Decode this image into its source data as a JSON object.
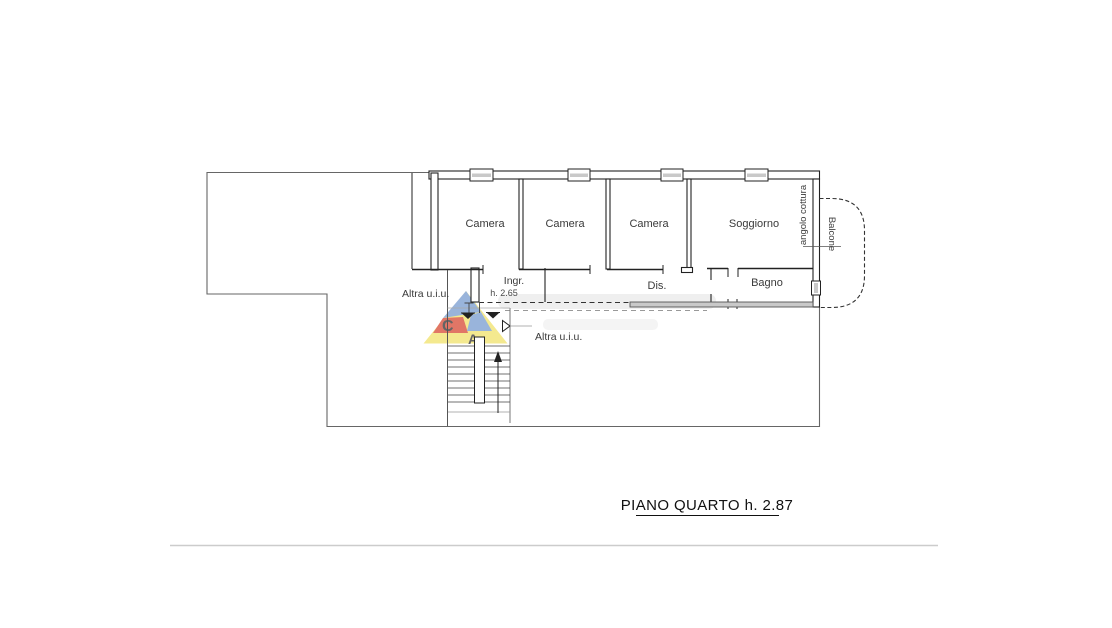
{
  "page": {
    "background": "#ffffff",
    "footer_rule_color": "#cccccc"
  },
  "plan": {
    "title": "PIANO QUARTO h. 2.87",
    "labels": {
      "camera1": "Camera",
      "camera2": "Camera",
      "camera3": "Camera",
      "soggiorno": "Soggiorno",
      "angolo_cottura": "angolo cottura",
      "balcone": "Balcone",
      "ingresso": "Ingr.",
      "ingresso_height": "h. 2.65",
      "disimpegno": "Dis.",
      "bagno": "Bagno",
      "altra_uiu_left": "Altra u.i.u.",
      "altra_uiu_right": "Altra u.i.u."
    },
    "colors": {
      "wall": "#222222",
      "outline": "#666666",
      "thin_line": "#555555",
      "light_line": "#999999",
      "window_fill": "#c9c9c9"
    }
  },
  "watermark": {
    "letter_c": "C",
    "letter_a": "A.",
    "colors": {
      "blue": "#7d9fd1",
      "red": "#d9503c",
      "yellow": "#f2e370",
      "c": "#cf3f2c",
      "a": "#e2a43c"
    }
  }
}
